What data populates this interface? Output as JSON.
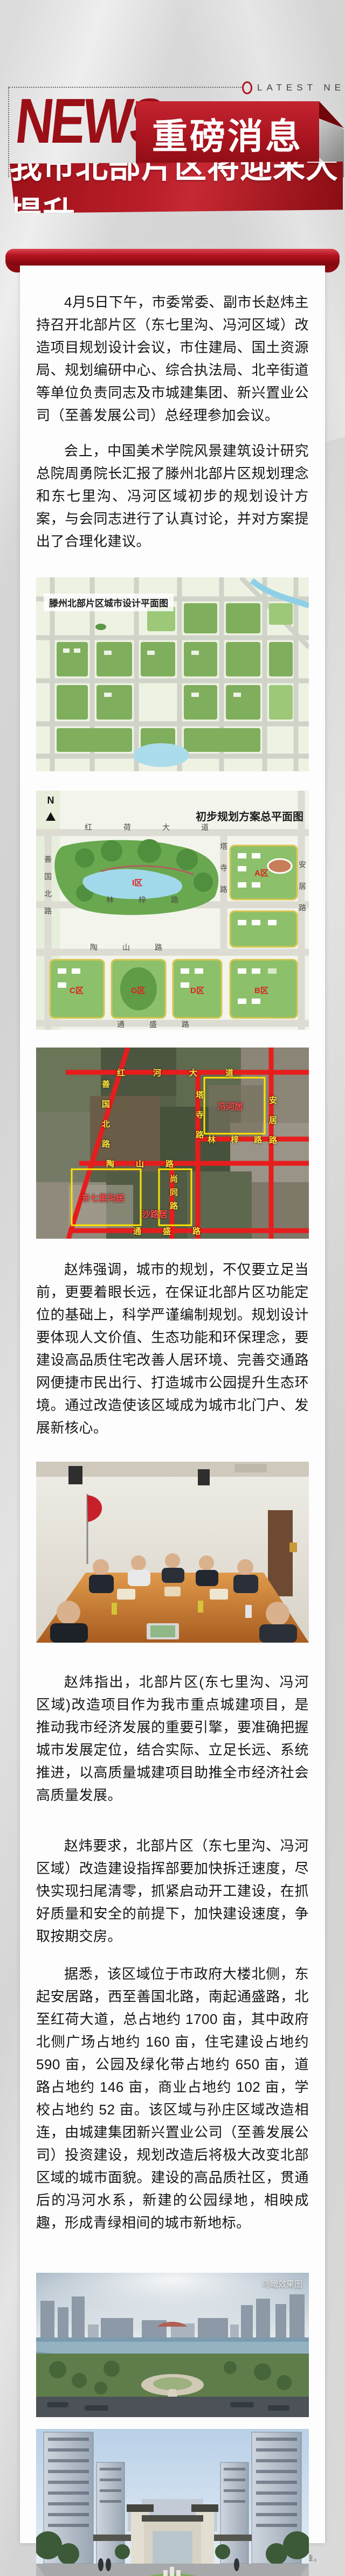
{
  "header": {
    "latest_news": "LATEST NEWS",
    "news_logo": "NEWS",
    "badge": "重磅消息",
    "title": "我市北部片区将迎来大提升"
  },
  "article": {
    "paragraphs": [
      "4月5日下午，市委常委、副市长赵炜主持召开北部片区（东七里沟、冯河区域）改造项目规划设计会议，市住建局、国土资源局、规划编研中心、综合执法局、北辛街道等单位负责同志及市城建集团、新兴置业公司（至善发展公司）总经理参加会议。",
      "会上，中国美术学院风景建筑设计研究总院周勇院长汇报了滕州北部片区规划理念和东七里沟、冯河区域初步的规划设计方案，与会同志进行了认真讨论，并对方案提出了合理化建议。",
      "赵炜强调，城市的规划，不仅要立足当前，更要着眼长远，在保证北部片区功能定位的基础上，科学严谨编制规划。规划设计要体现人文价值、生态功能和环保理念，要建设高品质住宅改善人居环境、完善交通路网便捷市民出行、打造城市公园提升生态环境。通过改造使该区域成为城市北门户、发展新核心。",
      "赵炜指出，北部片区(东七里沟、冯河区域)改造项目作为我市重点城建项目，是推动我市经济发展的重要引擎，要准确把握城市发展定位，结合实际、立足长远、系统推进，以高质量城建项目助推全市经济社会高质量发展。",
      "赵炜要求，北部片区（东七里沟、冯河区域）改造建设指挥部要加快拆迁速度，尽快实现扫尾清零，抓紧启动开工建设，在抓好质量和安全的前提下，加快建设速度，争取按期交房。",
      "据悉，该区域位于市政府大楼北侧，东起安居路，西至善国北路，南起通盛路，北至红荷大道，总占地约 1700 亩，其中政府北侧广场占地约 160 亩，住宅建设占地约 590 亩，公园及绿化带占地约 650 亩，道路占地约 146 亩，商业占地约 102 亩，学校占地约 52 亩。该区域与孙庄区域改造相连，由城建集团新兴置业公司（至善发展公司）投资建设，规划改造后将极大改变北部区域的城市面貌。建设的高品质社区，贯通后的冯河水系，新建的公园绿地，相映成趣，形成青绿相间的城市新地标。"
    ]
  },
  "figures": {
    "plan1": {
      "caption": "滕州北部片区城市设计平面图"
    },
    "plan2": {
      "caption": "初步规划方案总平面图",
      "north_label": "N",
      "road_top": "红荷大道",
      "road_mid": "林梓路",
      "road_lower": "陶山路",
      "road_bottom": "通盛路",
      "road_right_v": "塔寺路",
      "road_right_edge": "安居路",
      "road_left_v": "善国北路",
      "zone_lake": "I区",
      "zone_a": "A区",
      "zone_b": "B区",
      "zone_c": "C区",
      "zone_d": "D区",
      "zone_g": "G区"
    },
    "aerial": {
      "road_top": "红河大道",
      "road_diag": "善国北路",
      "road_mid": "林梓路",
      "road_lower": "陶山路",
      "road_bottom": "通盛路",
      "road_v1": "塔寺路",
      "road_v2": "尚同路",
      "road_right": "安居路",
      "area_1": "冯河居",
      "area_2": "沙路居",
      "area_3": "东七里沟居"
    },
    "render1": {
      "watermark": "鸟瞰效果图"
    },
    "render2": {
      "watermark": "效果图"
    }
  },
  "footer": {
    "disclaimer": "免责声明：本资料效果图仅供参考，一切以政府最终批准文件为准。"
  }
}
